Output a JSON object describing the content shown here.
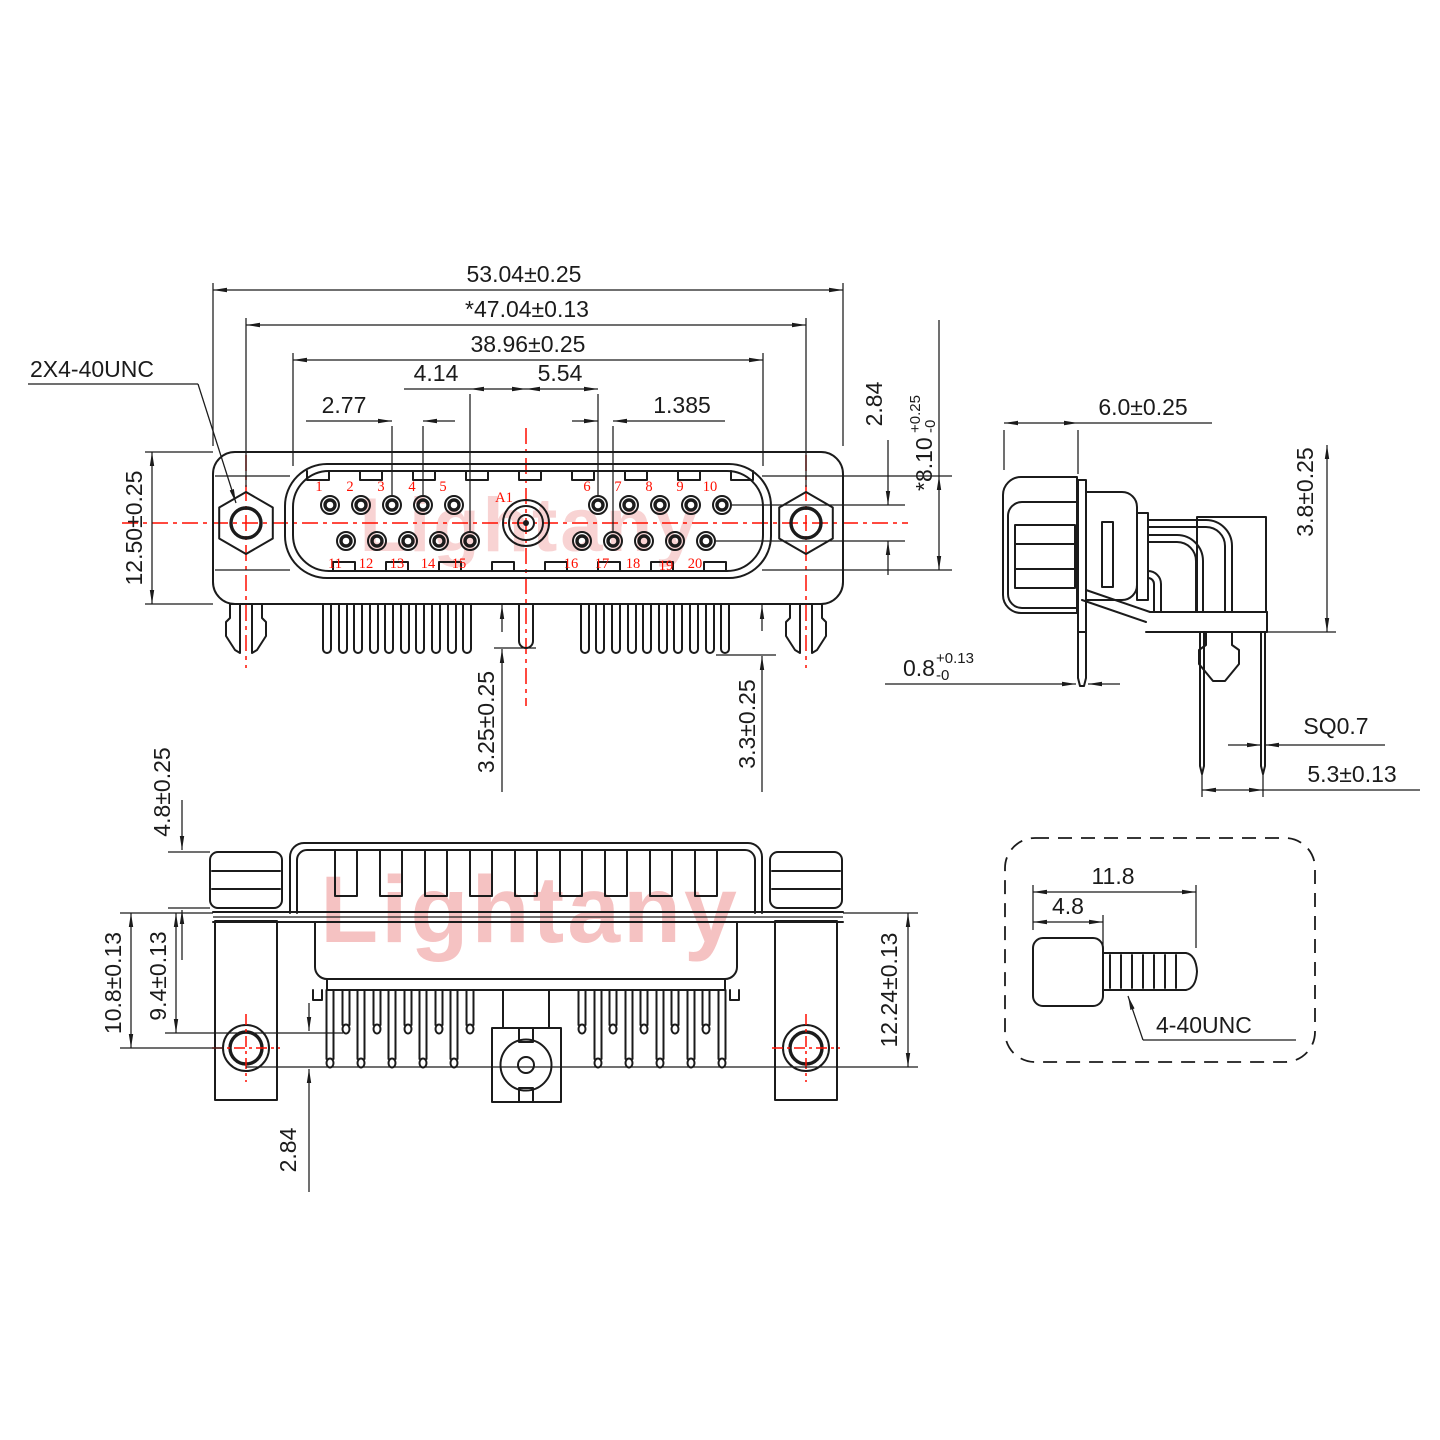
{
  "watermarks": {
    "front": "Lightany",
    "bottom": "Lightany"
  },
  "front_view": {
    "thread_callout": "2X4-40UNC",
    "dims": {
      "overall_width": "53.04±0.25",
      "mounting_span": "*47.04±0.13",
      "shell_width": "38.96±0.25",
      "coax_to_pin_left": "4.14",
      "coax_to_pin_right": "5.54",
      "pin_pitch": "2.77",
      "row_offset": "1.385",
      "flange_height": "12.50±0.25",
      "row_gap": "2.84",
      "pocket_height": "*8.10",
      "pocket_tol_plus": "+0.25",
      "pocket_tol_minus": "-0",
      "coax_tail_len": "3.25±0.25",
      "pin_tail_len": "3.3±0.25"
    },
    "coax_label": "A1",
    "pin_labels": [
      "1",
      "2",
      "3",
      "4",
      "5",
      "6",
      "7",
      "8",
      "9",
      "10",
      "11",
      "12",
      "13",
      "14",
      "15",
      "16",
      "17",
      "18",
      "19",
      "20"
    ]
  },
  "side_view": {
    "dims": {
      "insert_depth": "6.0±0.25",
      "standoff": "3.8±0.25",
      "bracket_thickness": "0.8",
      "bracket_tol_plus": "+0.13",
      "bracket_tol_minus": "-0",
      "pin_square": "SQ0.7",
      "pin_row_span": "5.3±0.13"
    }
  },
  "bottom_view": {
    "dims": {
      "nut_height": "4.8±0.25",
      "lock_depth": "10.8±0.13",
      "pin_depth": "9.4±0.13",
      "row_stagger": "2.84",
      "board_span": "12.24±0.13"
    }
  },
  "screw_detail": {
    "dims": {
      "overall_length": "11.8",
      "head_length": "4.8"
    },
    "thread_label": "4-40UNC"
  }
}
